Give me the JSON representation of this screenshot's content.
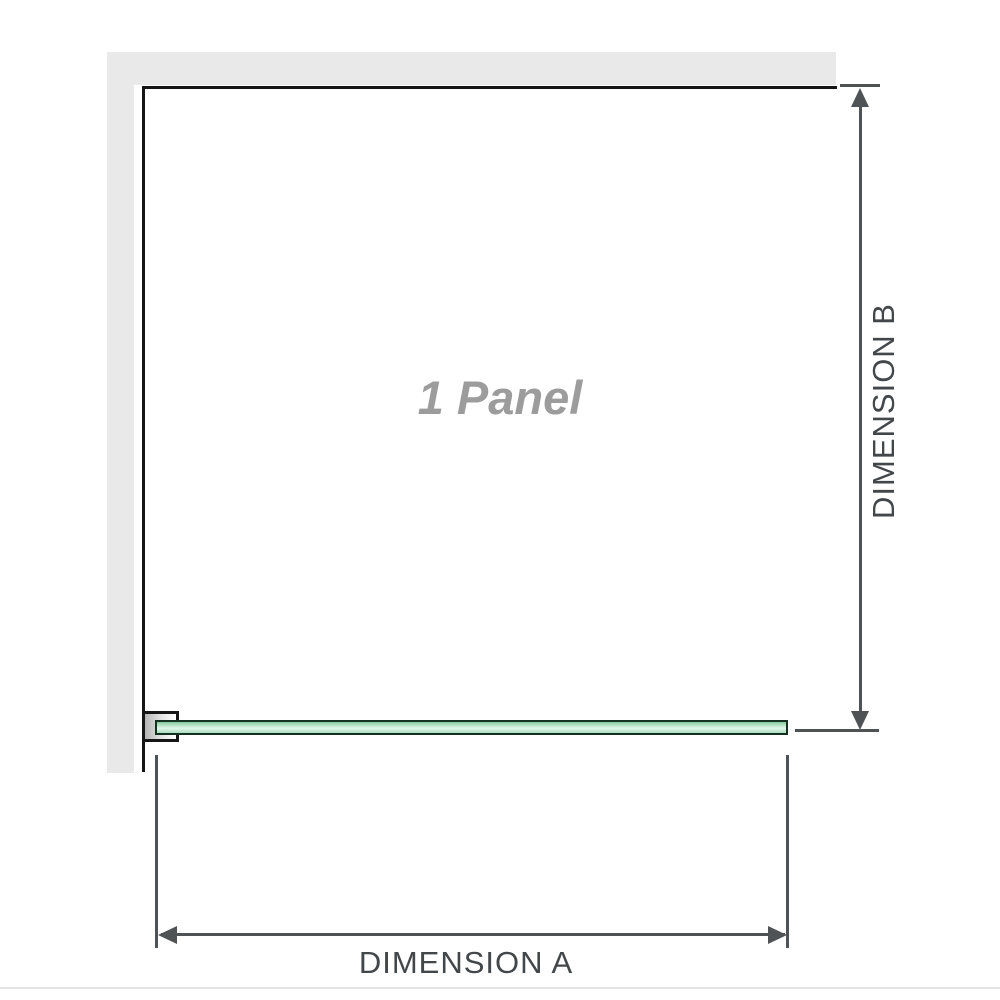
{
  "diagram": {
    "panel_label": "1 Panel",
    "dimension_a_label": "DIMENSION A",
    "dimension_b_label": "DIMENSION B"
  },
  "colors": {
    "wall_fill": "#e9e9e9",
    "panel_outline": "#161616",
    "dimension_line": "#4f5356",
    "dimension_text": "#43474a",
    "panel_label_text": "#9c9c9c",
    "glass_border": "#16301f",
    "glass_green": "#a8ddbf",
    "glass_green_light": "#cfeeda",
    "glass_green_dark": "#83cb9e",
    "bracket_fill_dark": "#b5b5b5",
    "bracket_fill_light": "#ffffff",
    "divider": "#e3e3e3"
  }
}
